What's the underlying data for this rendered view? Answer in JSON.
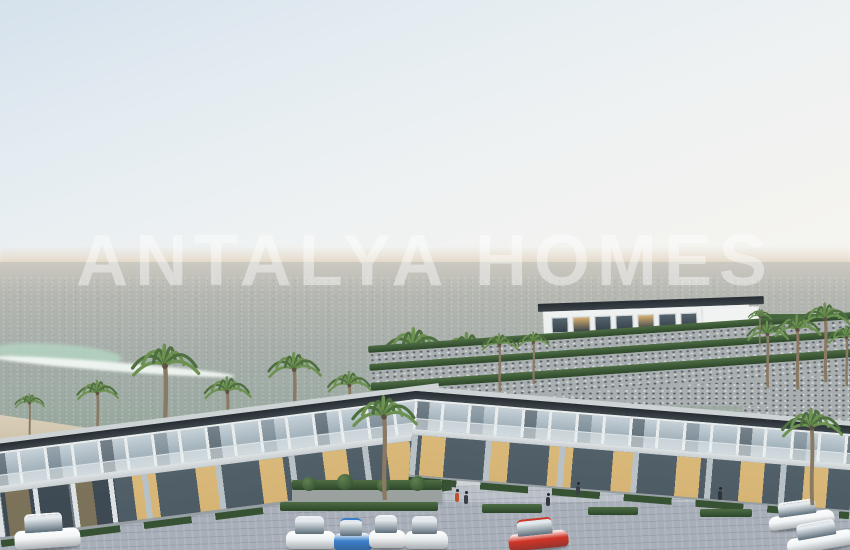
{
  "watermark": "ANTALYA HOMES",
  "palette": {
    "sky_top": "#d5e1ec",
    "sky_bottom": "#f6f4ef",
    "horizon_haze": "#e0d6c6",
    "sea_top": "#ccc9c1",
    "sea_bottom": "#92a397",
    "foam": "#f5faf6",
    "shallow": "#b4d3c1",
    "sand": "#d5cab2",
    "stone_wall": "#a9aeb0",
    "hedge_green": "#33502f",
    "roof_dark": "#2e353a",
    "facade_white": "#eef0f1",
    "slab": "#d7dcdf",
    "glass_reflect": "#b4c2cb",
    "glass_dark": "#46545e",
    "interior_glow": "#e9bf7d",
    "pavement": "#aab1ba",
    "plaza_walk": "#ced3d7",
    "palm_trunk": "#8b7a63",
    "palm_frond_dark": "#4e6f3e",
    "palm_frond_light": "#6d9150",
    "car_blue": "#3b7ec9",
    "car_red": "#cf3527",
    "car_white": "#f3f5f6"
  },
  "palms": {
    "back_row": [
      [
        30,
        442,
        46
      ],
      [
        98,
        447,
        64
      ],
      [
        166,
        452,
        104
      ],
      [
        228,
        452,
        72
      ],
      [
        295,
        438,
        82
      ],
      [
        350,
        442,
        68
      ],
      [
        415,
        430,
        98
      ],
      [
        468,
        430,
        94
      ],
      [
        520,
        438,
        78
      ]
    ],
    "hill_left": [
      [
        500,
        392,
        56
      ],
      [
        534,
        384,
        50
      ]
    ],
    "hill_right": [
      [
        768,
        388,
        64
      ],
      [
        798,
        390,
        72
      ],
      [
        826,
        382,
        76
      ],
      [
        847,
        386,
        58
      ],
      [
        760,
        346,
        36
      ]
    ],
    "front": [
      [
        385,
        500,
        100
      ],
      [
        812,
        505,
        93
      ]
    ]
  },
  "hillside_building": {
    "top_windows": 7,
    "bottom_windows": 6,
    "warm_top": [
      1,
      4
    ],
    "warm_bottom": [
      2,
      5
    ],
    "window_dark": "#37424a",
    "window_warm": "#d8b070"
  },
  "terrace_rows": [
    {
      "kind": "hedge",
      "h": 7
    },
    {
      "kind": "stone",
      "h": 11
    },
    {
      "kind": "hedge",
      "h": 7
    },
    {
      "kind": "stone",
      "h": 12
    },
    {
      "kind": "hedge",
      "h": 8
    },
    {
      "kind": "stone",
      "h": 16
    }
  ],
  "cars": [
    {
      "name": "white-suv-left",
      "x": 14,
      "y": 516,
      "w": 66,
      "h": 33,
      "color": "#f4f6f7",
      "angle": -4
    },
    {
      "name": "white-sedan-1",
      "x": 286,
      "y": 519,
      "w": 50,
      "h": 31,
      "color": "#eef1f3",
      "angle": 0
    },
    {
      "name": "blue-sedan",
      "x": 334,
      "y": 521,
      "w": 38,
      "h": 31,
      "color": "#3b7ec9",
      "angle": 0
    },
    {
      "name": "white-pickup",
      "x": 369,
      "y": 518,
      "w": 37,
      "h": 31,
      "color": "#f2f3f4",
      "angle": 0
    },
    {
      "name": "white-sedan-2",
      "x": 405,
      "y": 519,
      "w": 43,
      "h": 31,
      "color": "#e9edef",
      "angle": 0
    },
    {
      "name": "red-coupe",
      "x": 508,
      "y": 521,
      "w": 60,
      "h": 29,
      "color": "#cf3527",
      "angle": -6
    },
    {
      "name": "white-car-right-1",
      "x": 768,
      "y": 503,
      "w": 66,
      "h": 25,
      "color": "#f3f5f6",
      "angle": -8
    },
    {
      "name": "white-car-right-2",
      "x": 786,
      "y": 524,
      "w": 68,
      "h": 27,
      "color": "#eff2f4",
      "angle": -10
    }
  ],
  "people": [
    {
      "x": 455,
      "y": 493,
      "color": "#c0512f"
    },
    {
      "x": 464,
      "y": 495,
      "color": "#3a3f44"
    },
    {
      "x": 546,
      "y": 497,
      "color": "#33383c"
    },
    {
      "x": 576,
      "y": 486,
      "color": "#3a4045"
    },
    {
      "x": 718,
      "y": 491,
      "color": "#2f3438"
    }
  ],
  "bushes": [
    {
      "x": 10,
      "y": 4,
      "s": 14
    },
    {
      "x": 45,
      "y": 2,
      "s": 16
    },
    {
      "x": 85,
      "y": 5,
      "s": 13
    },
    {
      "x": 118,
      "y": 3,
      "s": 15
    }
  ],
  "side_hedges": [
    {
      "x": 280,
      "y": 502,
      "w": 158,
      "h": 9
    },
    {
      "x": 482,
      "y": 504,
      "w": 60,
      "h": 9
    },
    {
      "x": 588,
      "y": 507,
      "w": 50,
      "h": 8
    },
    {
      "x": 700,
      "y": 509,
      "w": 52,
      "h": 8
    }
  ]
}
